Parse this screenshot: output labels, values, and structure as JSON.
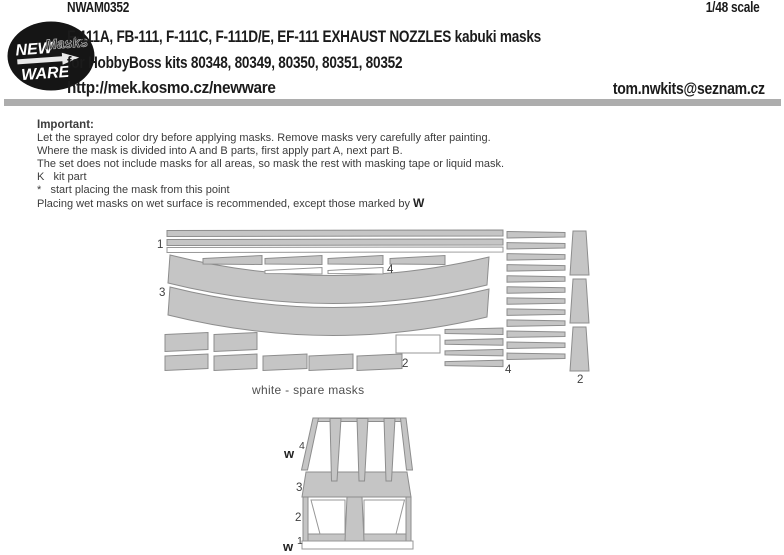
{
  "header": {
    "product_code": "NWAM0352",
    "scale": "1/48 scale",
    "title": "F-111A, FB-111, F-111C, F-111D/E,  EF-111 EXHAUST NOZZLES kabuki masks",
    "subtitle": "for HobbyBoss kits 80348, 80349, 80350, 80351, 80352",
    "website": "http://mek.kosmo.cz/newware",
    "email": "tom.nwkits@seznam.cz",
    "logo": {
      "word1": "NEW",
      "word2": "Masks",
      "word3": "WARE"
    }
  },
  "instructions": {
    "heading": "Important:",
    "lines": [
      "Let the sprayed color dry before applying masks. Remove masks very carefully after painting.",
      "Where the mask is divided into A and B parts, first apply part A, next part B.",
      "The set does not include masks for all areas, so mask the rest with masking tape or liquid mask.",
      "K   kit part",
      "*   start placing the mask from this point",
      "Placing wet masks on wet surface is recommended, except those marked by "
    ],
    "wet_marker": "W"
  },
  "mask_sheet": {
    "caption": "white - spare masks",
    "labels": {
      "part1": "1",
      "part2": "2",
      "part3": "3",
      "part4": "4"
    },
    "strip_counts": {
      "long_strips": 3,
      "top_row": 4,
      "top_row_white": 2,
      "right_column": 12,
      "lower_left_group": 4,
      "right_trapezoids": 3,
      "bottom_row1": 2,
      "bottom_row2": 5
    }
  },
  "nozzle": {
    "labels": {
      "w": "w",
      "part1": "1",
      "part2": "2",
      "part3": "3",
      "part4": "4"
    }
  },
  "colors": {
    "mask_fill": "#c5c5c5",
    "mask_outline": "#8d8d8d",
    "spare_fill": "#ffffff",
    "divider": "#adadad",
    "header_text": "#1b1b1b",
    "body_text": "#3c3c3c",
    "logo_bg": "#151515"
  }
}
